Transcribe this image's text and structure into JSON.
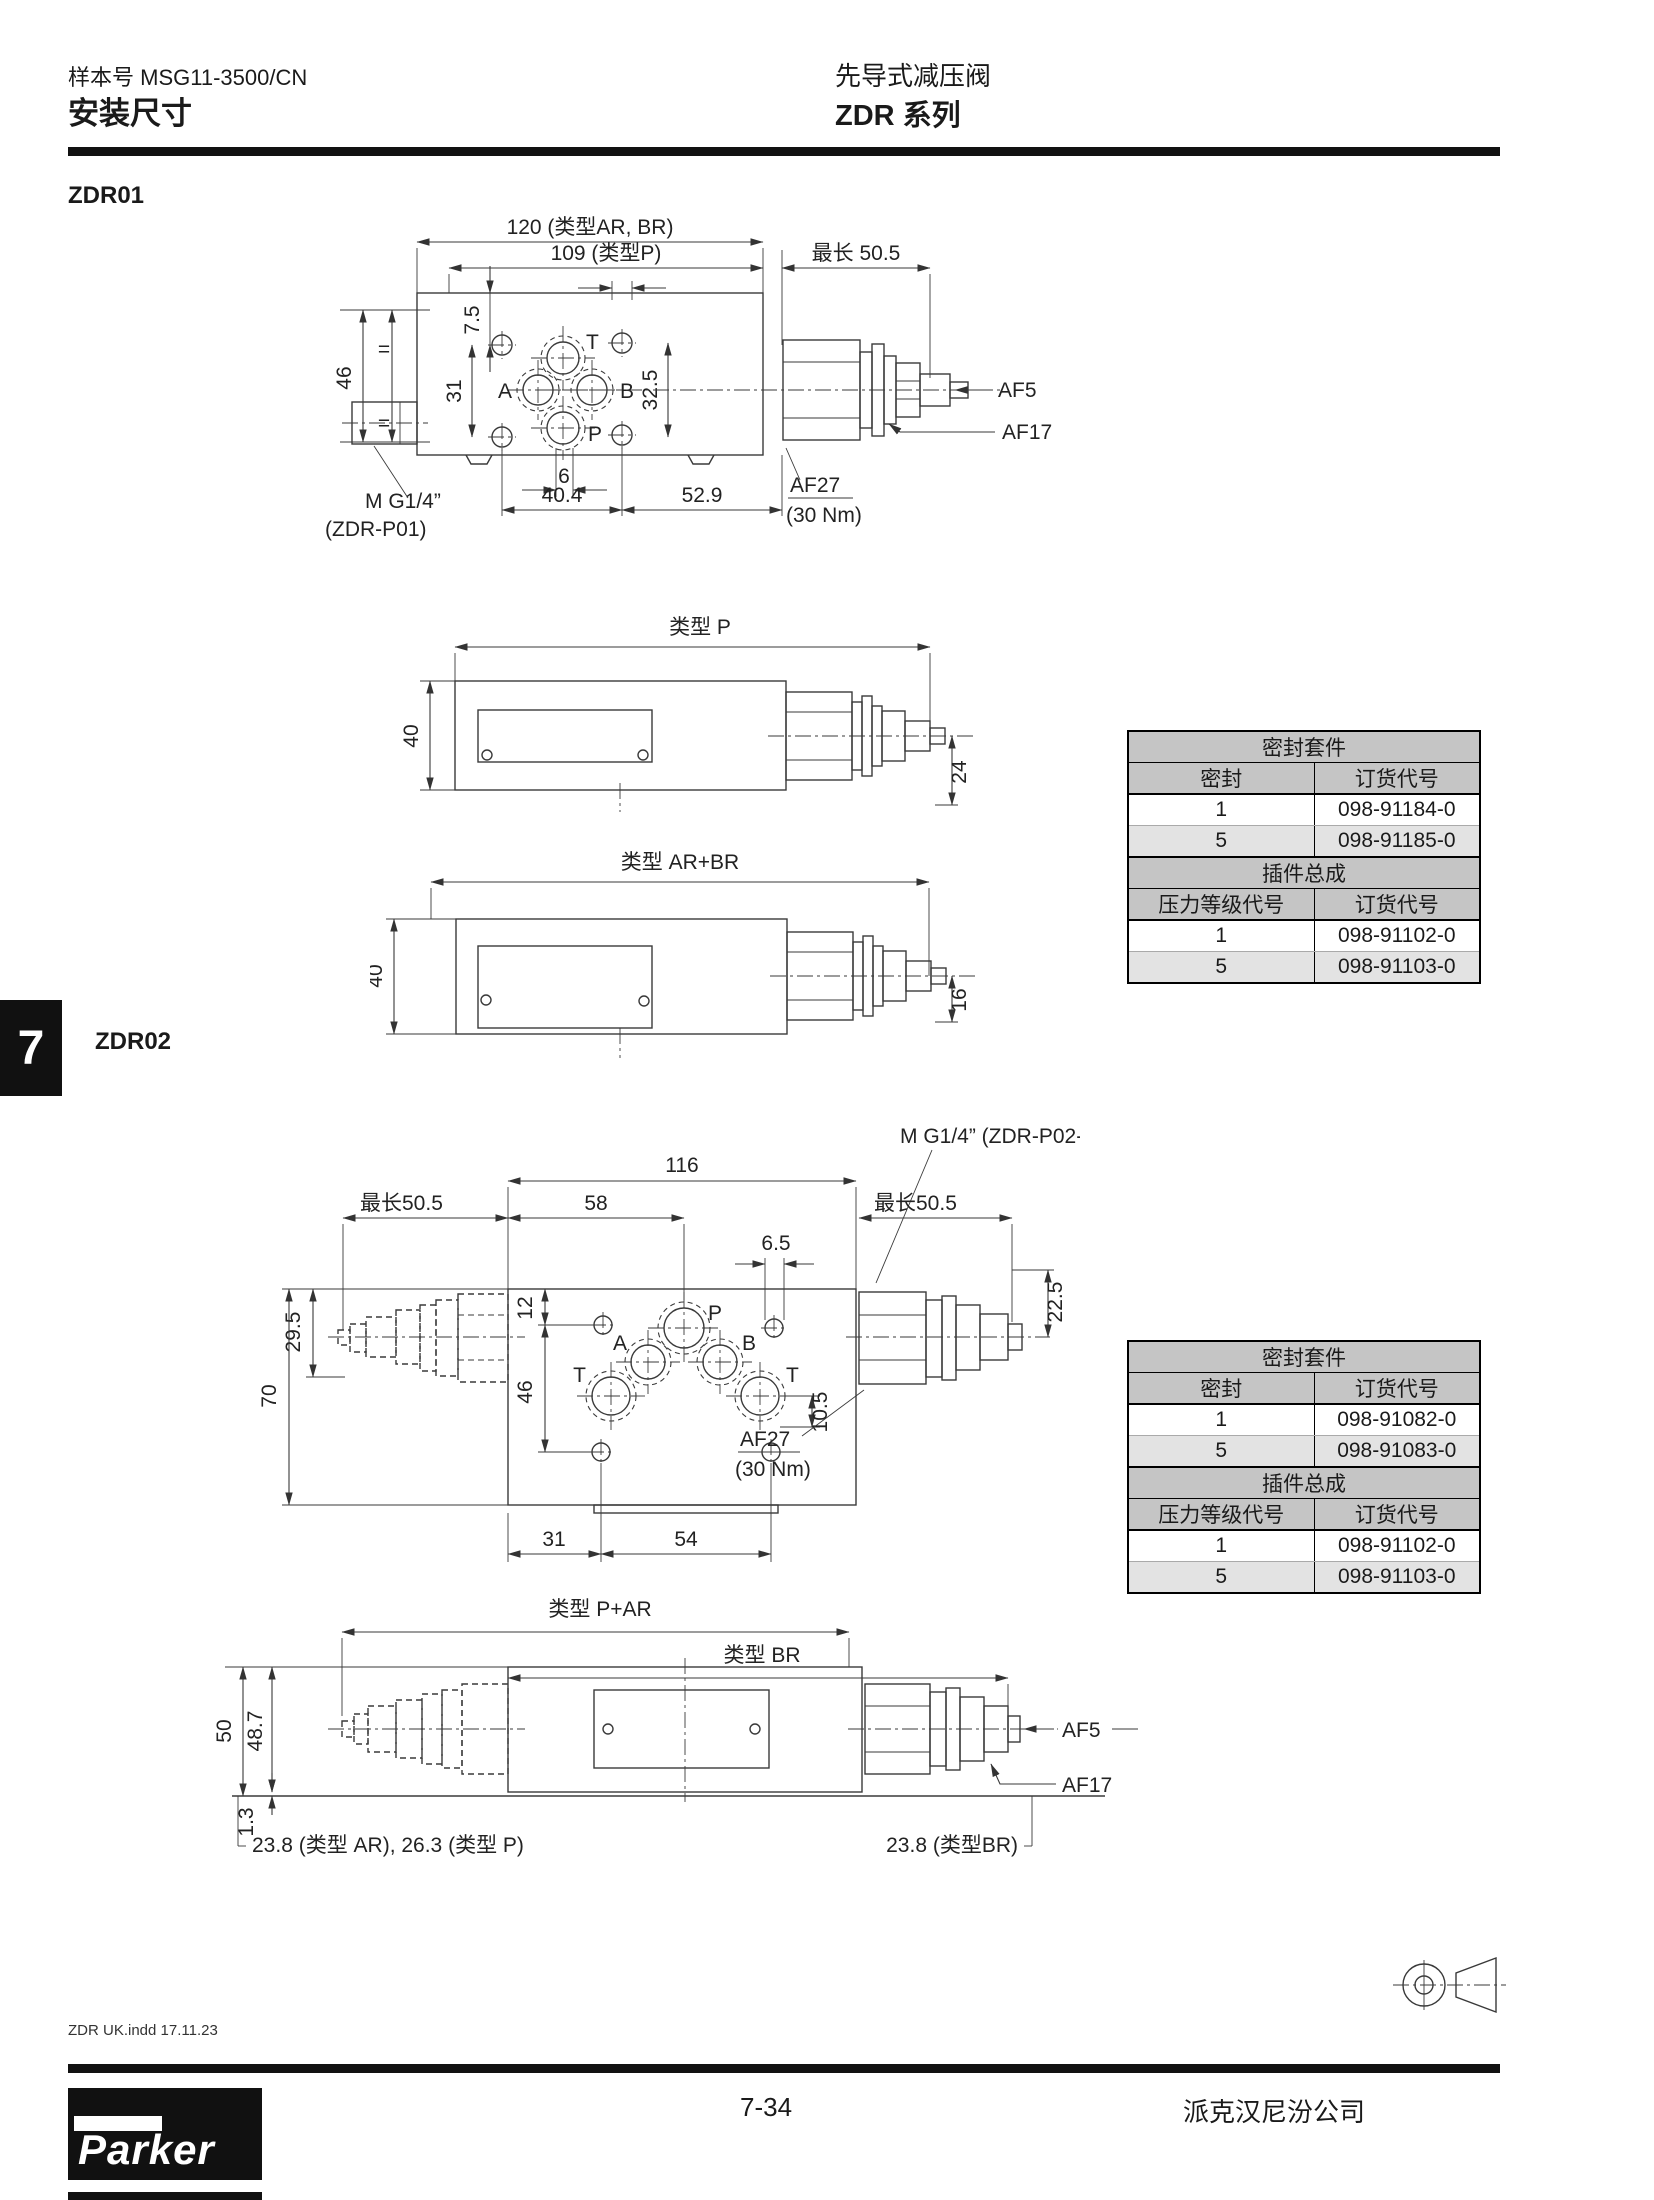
{
  "header": {
    "catalog": "样本号 MSG11-3500/CN",
    "section": "安装尺寸",
    "product": "先导式减压阀",
    "series": "ZDR 系列"
  },
  "tab": {
    "label": "7"
  },
  "zdr01": {
    "heading": "ZDR01",
    "d120": "120 (类型AR, BR)",
    "d109": "109 (类型P)",
    "dmax": "最长 50.5",
    "d75": "7.5",
    "d46": "46",
    "deq": "=",
    "d31": "31",
    "d325": "32.5",
    "d6": "6",
    "d404": "40.4",
    "d529": "52.9",
    "mthread": "M G1/4”",
    "mthread2": "(ZDR-P01)",
    "af27": "AF27",
    "af27b": "(30 Nm)",
    "af5": "AF5",
    "af17": "AF17",
    "pt": "T",
    "pa": "A",
    "pb": "B",
    "pp": "P",
    "viewP": {
      "title": "类型 P",
      "d40": "40",
      "d24": "24"
    },
    "viewAB": {
      "title": "类型 AR+BR",
      "d40": "40",
      "d16": "16"
    }
  },
  "table1": {
    "title": "密封套件",
    "c1": "密封",
    "c2": "订货代号",
    "r1": [
      "1",
      "098-91184-0"
    ],
    "r2": [
      "5",
      "098-91185-0"
    ],
    "title2": "插件总成",
    "c3": "压力等级代号",
    "c4": "订货代号",
    "r3": [
      "1",
      "098-91102-0"
    ],
    "r4": [
      "5",
      "098-91103-0"
    ]
  },
  "zdr02": {
    "heading": "ZDR02",
    "d116": "116",
    "d58": "58",
    "d65": "6.5",
    "dmaxl": "最长50.5",
    "dmaxr": "最长50.5",
    "d295": "29.5",
    "d70": "70",
    "d12": "12",
    "d46": "46",
    "d105": "10.5",
    "d225": "22.5",
    "d31": "31",
    "d54": "54",
    "mthread": "M G1/4” (ZDR-P02-...)",
    "af27": "AF27",
    "af27b": "(30 Nm)",
    "pa": "A",
    "pb": "B",
    "pp": "P",
    "pt1": "T",
    "pt2": "T",
    "bottom": {
      "t1": "类型 P+AR",
      "t2": "类型 BR",
      "d50": "50",
      "d487": "48.7",
      "d13": "1.3",
      "noteL": "23.8 (类型 AR), 26.3 (类型 P)",
      "noteR": "23.8 (类型BR)",
      "af5": "AF5",
      "af17": "AF17"
    }
  },
  "table2": {
    "title": "密封套件",
    "c1": "密封",
    "c2": "订货代号",
    "r1": [
      "1",
      "098-91082-0"
    ],
    "r2": [
      "5",
      "098-91083-0"
    ],
    "title2": "插件总成",
    "c3": "压力等级代号",
    "c4": "订货代号",
    "r3": [
      "1",
      "098-91102-0"
    ],
    "r4": [
      "5",
      "098-91103-0"
    ]
  },
  "footer": {
    "note": "ZDR UK.indd 17.11.23",
    "page": "7-34",
    "company": "派克汉尼汾公司",
    "logo": "Parker"
  }
}
